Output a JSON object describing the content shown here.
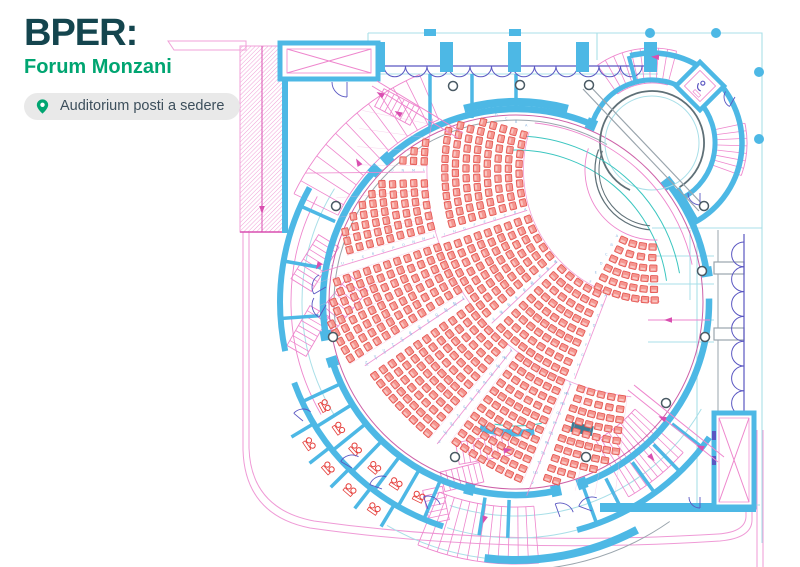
{
  "header": {
    "brand": "BPER:",
    "venue": "Forum Monzani",
    "badge_label": "Auditorium posti a sedere"
  },
  "colors": {
    "brand_dark": "#14454e",
    "brand_green": "#00a571",
    "badge_bg": "#e9e9e9",
    "badge_text": "#3d4f5c",
    "wall": "#4db8e5",
    "wall_dark": "#3e7d95",
    "thin": "#a9dfe8",
    "teal": "#3cc6c0",
    "magenta": "#d94fb0",
    "pink": "#ee86cd",
    "pink_light": "#f4b8e0",
    "purple": "#5a57c2",
    "slate": "#5f7077",
    "gray": "#9aa5ad",
    "seat_fill": "#f5968f",
    "seat_stroke": "#e35450",
    "seat_letter": "#8fb9e2",
    "toilet_red": "#e5403c"
  },
  "plan": {
    "shell": {
      "cx": 516,
      "cy": 302,
      "r": 193,
      "segments": [
        [
          104,
          162
        ],
        [
          170,
          223
        ],
        [
          228,
          293
        ],
        [
          322,
          351
        ],
        [
          359,
          430
        ],
        [
          438,
          464
        ]
      ],
      "jambs": [
        104,
        162,
        170,
        223,
        228,
        293,
        322,
        351,
        70,
        78
      ]
    },
    "outer_arcs": {
      "wall236": [
        [
          35,
          75
        ],
        [
          108,
          160
        ],
        [
          168,
          209
        ]
      ],
      "wall258": [
        [
          62,
          97
        ]
      ],
      "wall200": [
        [
          255,
          285
        ]
      ],
      "thin214": [
        [
          30,
          58
        ],
        [
          55,
          108
        ],
        [
          148,
          212
        ]
      ],
      "thin236": [
        [
          75,
          107
        ]
      ],
      "thin258": [
        [
          97,
          120
        ]
      ],
      "gray268": [
        [
          55,
          95
        ]
      ],
      "mag225": [
        [
          150,
          208
        ]
      ]
    },
    "fan": {
      "cx": 655,
      "cy": 170,
      "row_pitch": 10.6,
      "seat_pitch": 9.2,
      "seat_w": 7.4,
      "seat_h": 6.4,
      "clip_r": 186,
      "front_letters": "ABCDEFGHI",
      "rear_letters": "LMNOPQRSTUVZ",
      "rear_aisles": [
        111.5,
        128.5,
        146,
        163,
        179.5
      ],
      "front_aisles": [
        111,
        136.8,
        162.5
      ],
      "sections": [
        {
          "band": "rear",
          "a1": 97,
          "a2": 110,
          "r0": 231,
          "rows": 10
        },
        {
          "band": "rear",
          "a1": 113,
          "a2": 127,
          "r0": 231,
          "rows": 11
        },
        {
          "band": "rear",
          "a1": 130,
          "a2": 144.5,
          "r0": 231,
          "rows": 12
        },
        {
          "band": "rear",
          "a1": 147.5,
          "a2": 161.5,
          "r0": 231,
          "rows": 13
        },
        {
          "band": "rear",
          "a1": 164.5,
          "a2": 178,
          "r0": 231,
          "rows": 9
        },
        {
          "band": "rear",
          "a1": 181,
          "a2": 192.5,
          "r0": 231,
          "rows": 7
        },
        {
          "band": "front",
          "a1": 88,
          "a2": 118,
          "r0": 77,
          "rows": 6
        },
        {
          "band": "front",
          "a1": 113,
          "a2": 135.5,
          "r0": 136,
          "rows": 9
        },
        {
          "band": "front",
          "a1": 138.5,
          "a2": 161,
          "r0": 136,
          "rows": 9
        },
        {
          "band": "front",
          "a1": 164,
          "a2": 197,
          "r0": 136,
          "rows": 8
        }
      ]
    },
    "stairs_straight": [
      [
        315,
        263,
        52,
        24,
        -58,
        9
      ],
      [
        342,
        303,
        52,
        24,
        -50,
        9
      ],
      [
        308,
        331,
        46,
        22,
        -60,
        8
      ],
      [
        483,
        449,
        52,
        22,
        -10,
        9
      ],
      [
        462,
        477,
        40,
        20,
        -14,
        7
      ],
      [
        397,
        107,
        40,
        20,
        28,
        7
      ],
      [
        436,
        505,
        34,
        20,
        78,
        6
      ]
    ],
    "stairs_curved": [
      [
        516,
        302,
        198,
        247,
        206,
        247,
        12
      ],
      [
        516,
        302,
        160,
        225,
        42,
        60,
        10
      ],
      [
        516,
        302,
        205,
        262,
        85,
        112,
        12
      ],
      [
        652,
        143,
        60,
        95,
        235,
        285,
        9
      ],
      [
        652,
        143,
        62,
        95,
        348,
        380,
        7
      ]
    ],
    "columns": [
      [
        453,
        86
      ],
      [
        520,
        85
      ],
      [
        336,
        206
      ],
      [
        333,
        337
      ],
      [
        455,
        457
      ],
      [
        586,
        457
      ],
      [
        666,
        403
      ],
      [
        702,
        271
      ],
      [
        705,
        337
      ],
      [
        589,
        85
      ],
      [
        704,
        206
      ]
    ],
    "blue_dots": [
      [
        650,
        33
      ],
      [
        716,
        33
      ],
      [
        759,
        72
      ],
      [
        759,
        139
      ]
    ],
    "toilets": {
      "inner_angles": [
        116.5,
        123.5,
        130.5,
        137.5,
        144.5,
        151.5
      ],
      "inner_r": 216,
      "outer_angles": [
        124.5,
        131.5,
        138.5,
        145.5
      ],
      "outer_r": 249
    },
    "partitions": {
      "inner": [
        113,
        120,
        127,
        134,
        141,
        148,
        155
      ],
      "outer": [
        121,
        128,
        135,
        142,
        149
      ],
      "bottom": [
        63,
        70,
        92,
        99
      ],
      "left": [
        176,
        190,
        204
      ],
      "right": [
        38,
        46,
        54
      ]
    },
    "doors": [
      [
        347,
        82,
        15,
        90,
        180
      ],
      [
        326,
        287,
        14,
        150,
        240
      ],
      [
        326,
        305,
        14,
        120,
        210
      ],
      [
        352,
        468,
        13,
        210,
        300
      ],
      [
        382,
        489,
        13,
        200,
        290
      ],
      [
        303,
        421,
        12,
        220,
        310
      ],
      [
        560,
        517,
        14,
        250,
        340
      ],
      [
        592,
        511,
        14,
        200,
        290
      ],
      [
        700,
        193,
        12,
        90,
        180
      ],
      [
        735,
        97,
        11,
        120,
        210
      ],
      [
        700,
        497,
        11,
        90,
        180
      ],
      [
        428,
        509,
        13,
        250,
        340
      ]
    ],
    "routes": [
      [
        372,
        86,
        458,
        138
      ],
      [
        377,
        81,
        463,
        133
      ],
      [
        628,
        390,
        718,
        462
      ],
      [
        634,
        385,
        724,
        457
      ],
      [
        648,
        320,
        710,
        320
      ]
    ],
    "arrows": [
      [
        398,
        113,
        211
      ],
      [
        380,
        94,
        211
      ],
      [
        662,
        418,
        205
      ],
      [
        700,
        447,
        205
      ],
      [
        668,
        320,
        180
      ],
      [
        508,
        450,
        -8
      ],
      [
        358,
        162,
        240
      ],
      [
        652,
        458,
        50
      ],
      [
        484,
        520,
        108
      ],
      [
        318,
        266,
        122
      ],
      [
        262,
        210,
        90
      ],
      [
        655,
        57,
        185
      ]
    ]
  }
}
